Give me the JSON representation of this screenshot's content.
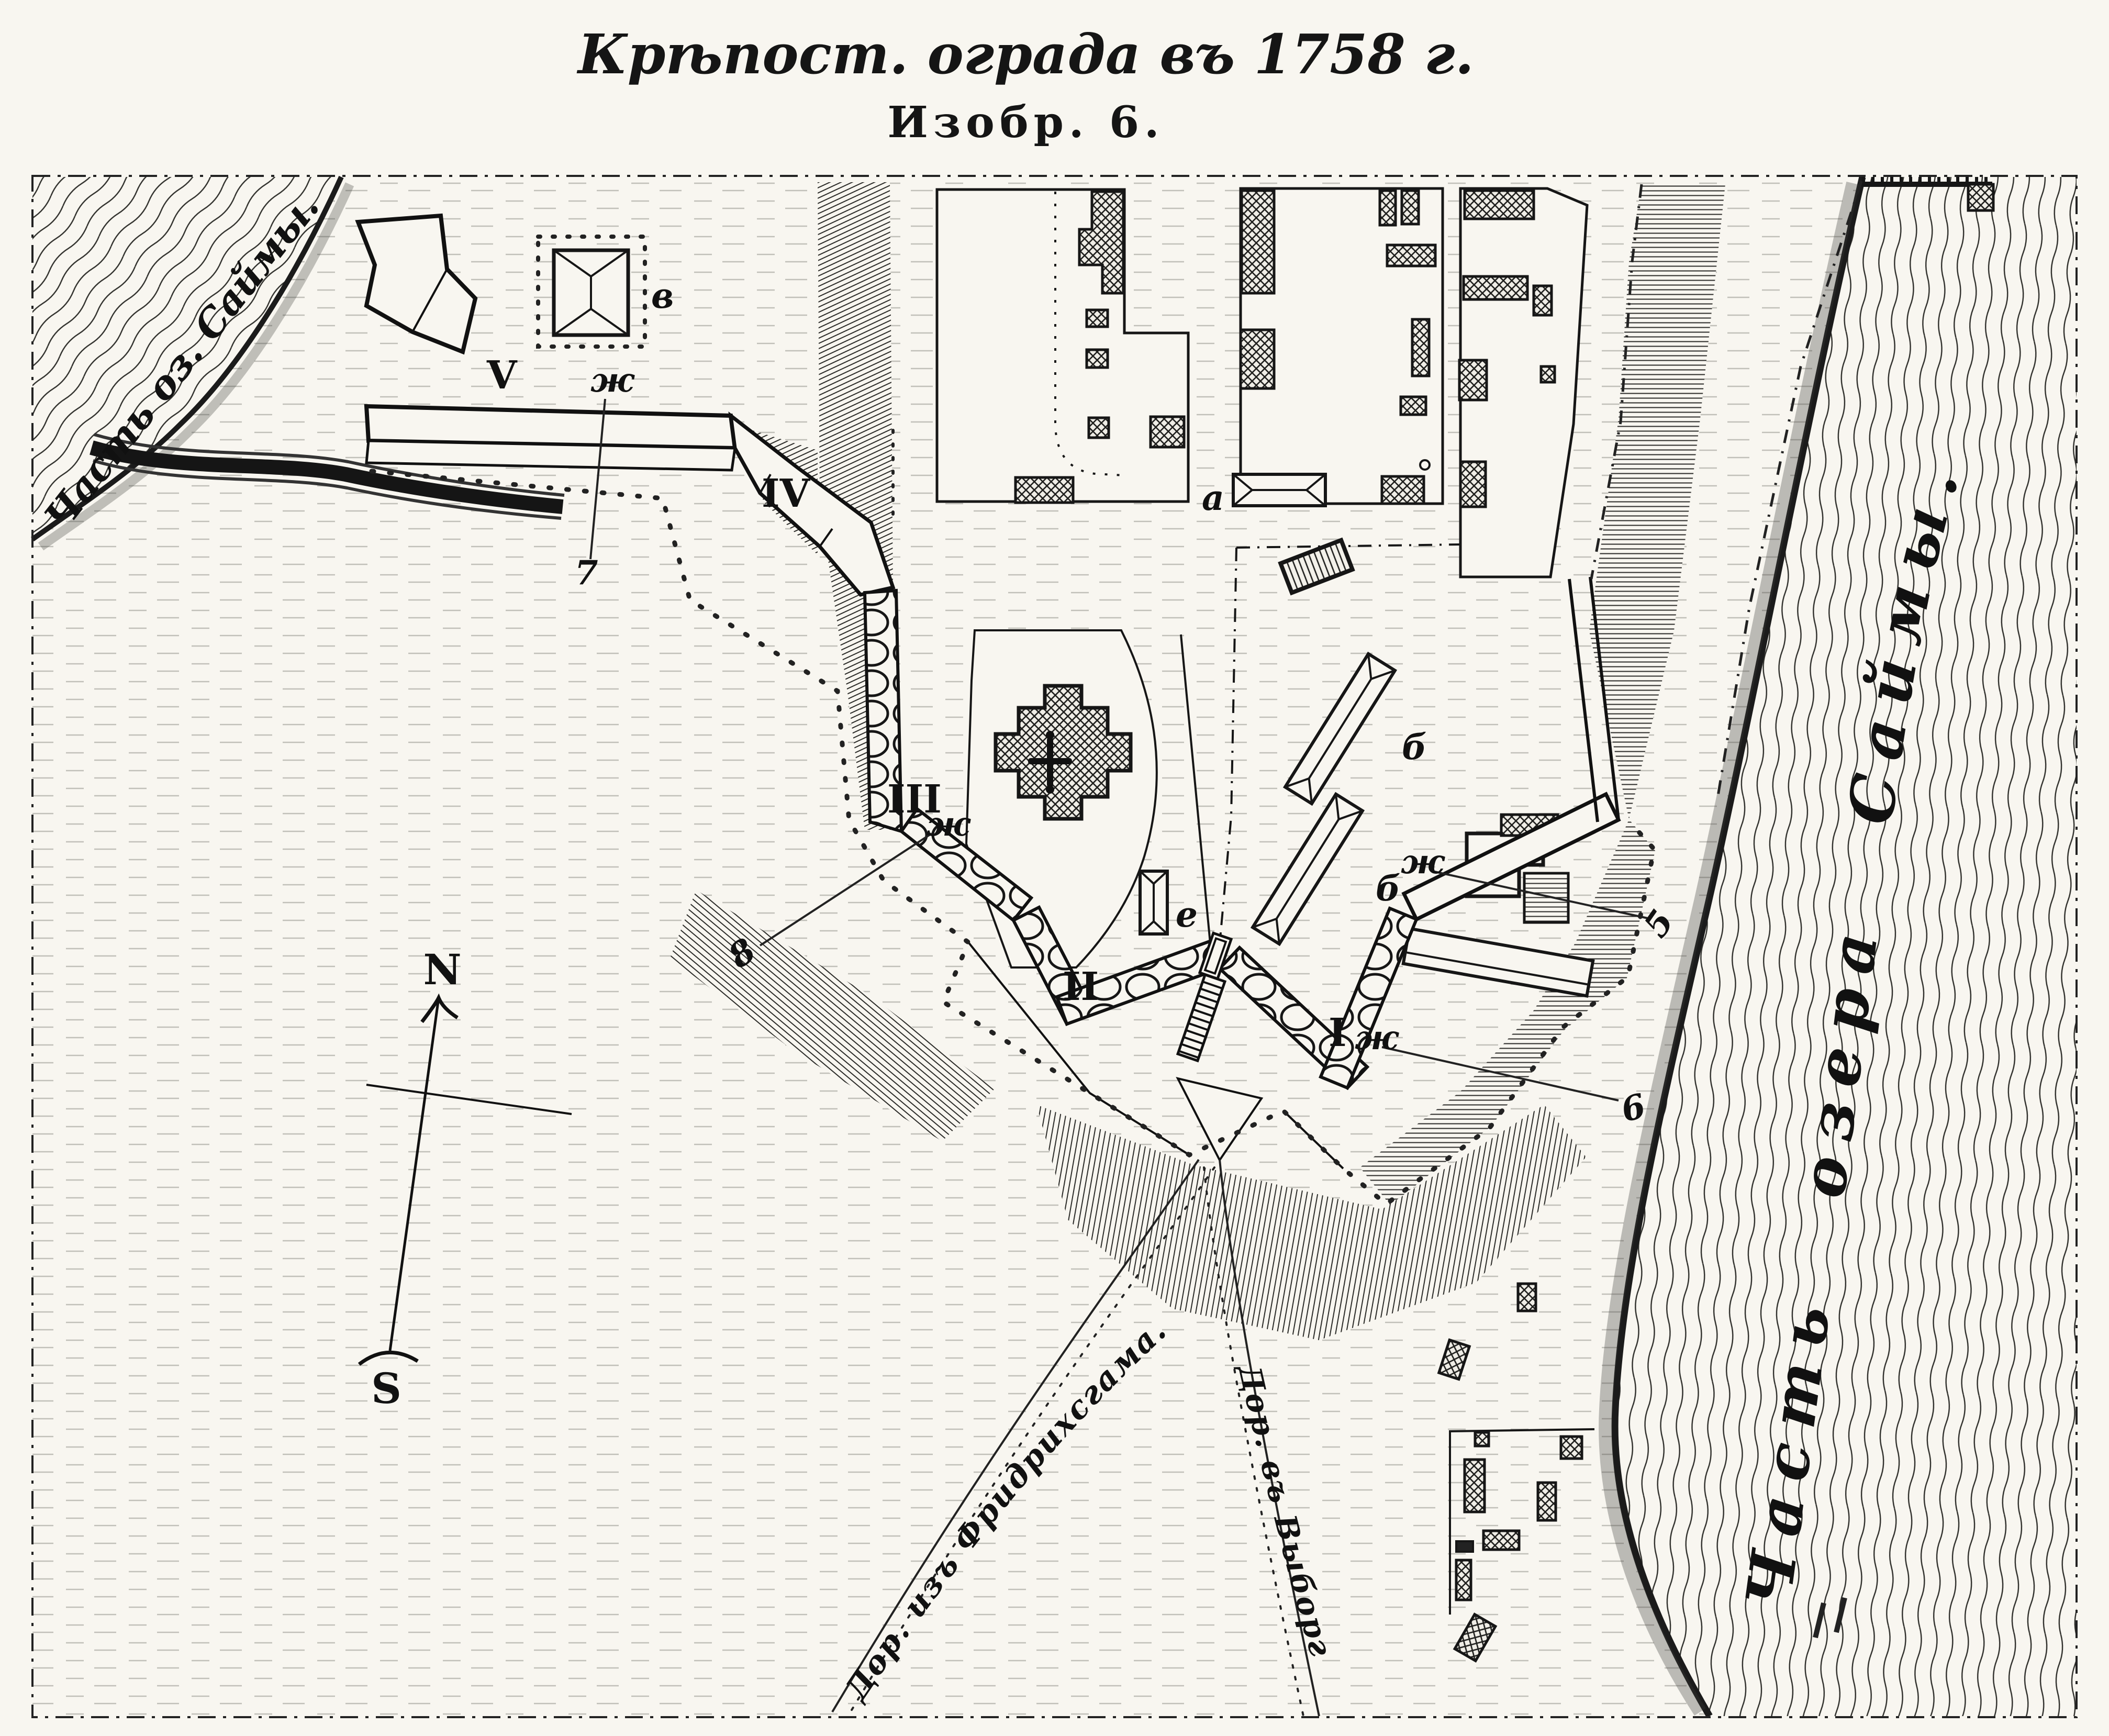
{
  "title": "Крѣпост. ограда въ 1758 г.",
  "figure_label": "Изобр. 6.",
  "water": {
    "left_label": "Часть оз. Саймы.",
    "right_label": "Часть озера Саймы."
  },
  "roads": {
    "from_fredrikshamn": "Дор. изъ Фридрихсгама.",
    "to_vyborg": "Дор. въ Выборгъ."
  },
  "compass": {
    "north": "N",
    "south": "S"
  },
  "bastions": [
    "V",
    "IV",
    "III",
    "II",
    "I"
  ],
  "marks": {
    "a": "а",
    "b": "б",
    "v": "в",
    "e": "е",
    "zh": "ж",
    "p5": "5",
    "p6": "6",
    "p7": "7",
    "p8": "8"
  },
  "colors": {
    "paper": "#f8f6f0",
    "ink": "#1c1c1c"
  }
}
